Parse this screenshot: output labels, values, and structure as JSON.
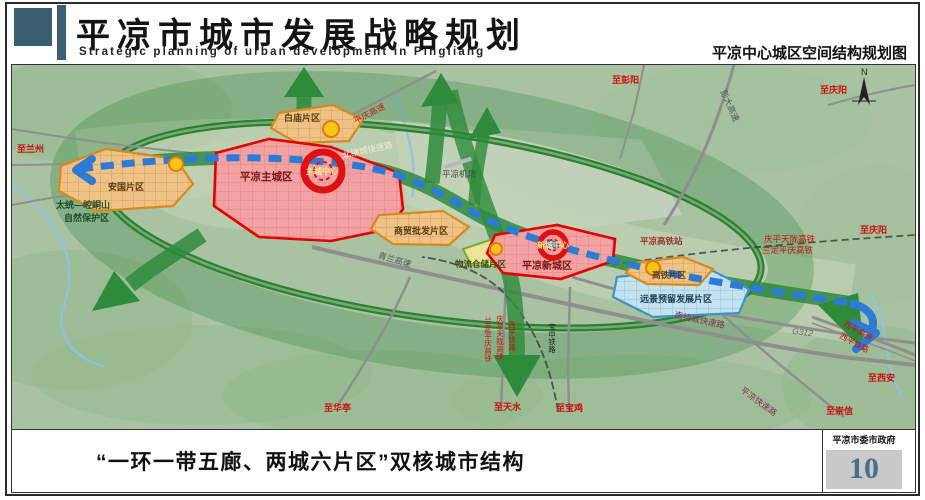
{
  "header": {
    "title": "平凉市城市发展战略规划",
    "subtitle": "Strategic planning of urban development in Pingliang",
    "map_title": "平凉中心城区空间结构规划图"
  },
  "footer": {
    "caption": "“一环一带五廊、两城六片区”双核城市结构",
    "agency": "平凉市委市政府",
    "page_number": "10"
  },
  "map": {
    "structure_concept": "一环一带五廊、两城六片区 双核城市结构",
    "cores": [
      "主城中心",
      "新城中心"
    ],
    "cities": [
      "平凉主城区",
      "平凉新城区"
    ],
    "districts": [
      "安国片区",
      "白庙片区",
      "商贸批发片区",
      "物流仓储片区",
      "高铁片区",
      "远景预留发展片区"
    ],
    "labels": [
      {
        "text": "至兰州"
      },
      {
        "text": "太统—崆峒山"
      },
      {
        "text": "自然保护区"
      },
      {
        "text": "安国片区"
      },
      {
        "text": "白庙片区"
      },
      {
        "text": "平凉主城区"
      },
      {
        "text": "主城中心"
      },
      {
        "text": "平庆高速"
      },
      {
        "text": "北绕城快速路"
      },
      {
        "text": "平凉机场"
      },
      {
        "text": "商贸批发片区"
      },
      {
        "text": "青兰高速"
      },
      {
        "text": "物流仓储片区"
      },
      {
        "text": "新城中心"
      },
      {
        "text": "平凉新城区"
      },
      {
        "text": "平凉高铁站"
      },
      {
        "text": "庆平天陇高铁"
      },
      {
        "text": "兰定平庆高铁"
      },
      {
        "text": "高铁片区"
      },
      {
        "text": "远景预留发展片区"
      },
      {
        "text": "南绕城快速路"
      },
      {
        "text": "G312"
      },
      {
        "text": "西平高速"
      },
      {
        "text": "西平铁路"
      },
      {
        "text": "至西安"
      },
      {
        "text": "平凉快速路"
      },
      {
        "text": "至崇信"
      },
      {
        "text": "至华亭"
      },
      {
        "text": "兰定平庆高铁"
      },
      {
        "text": "庆平天陇高铁"
      },
      {
        "text": "西平铁路"
      },
      {
        "text": "宝中铁路"
      },
      {
        "text": "至天水"
      },
      {
        "text": "至宝鸡"
      },
      {
        "text": "至彭阳"
      },
      {
        "text": "彭大高速"
      },
      {
        "text": "至庆阳"
      },
      {
        "text": "至庆阳"
      },
      {
        "text": "N"
      }
    ]
  },
  "colors": {
    "header_teal": "#3a5f70",
    "map_bg": "#a9c2a2",
    "ring_green": "#3c8a44",
    "corridor_green": "#2e8b3b",
    "axis_blue": "#2e7bd6",
    "zone_red_border": "#e10000",
    "zone_red_fill": "#f2a2a2",
    "zone_orange_border": "#d98a1f",
    "zone_orange_fill": "#efc287",
    "zone_blue_border": "#3e93c6",
    "zone_blue_fill": "#c3e2ee",
    "page_number_blue": "#4a6e8c"
  }
}
